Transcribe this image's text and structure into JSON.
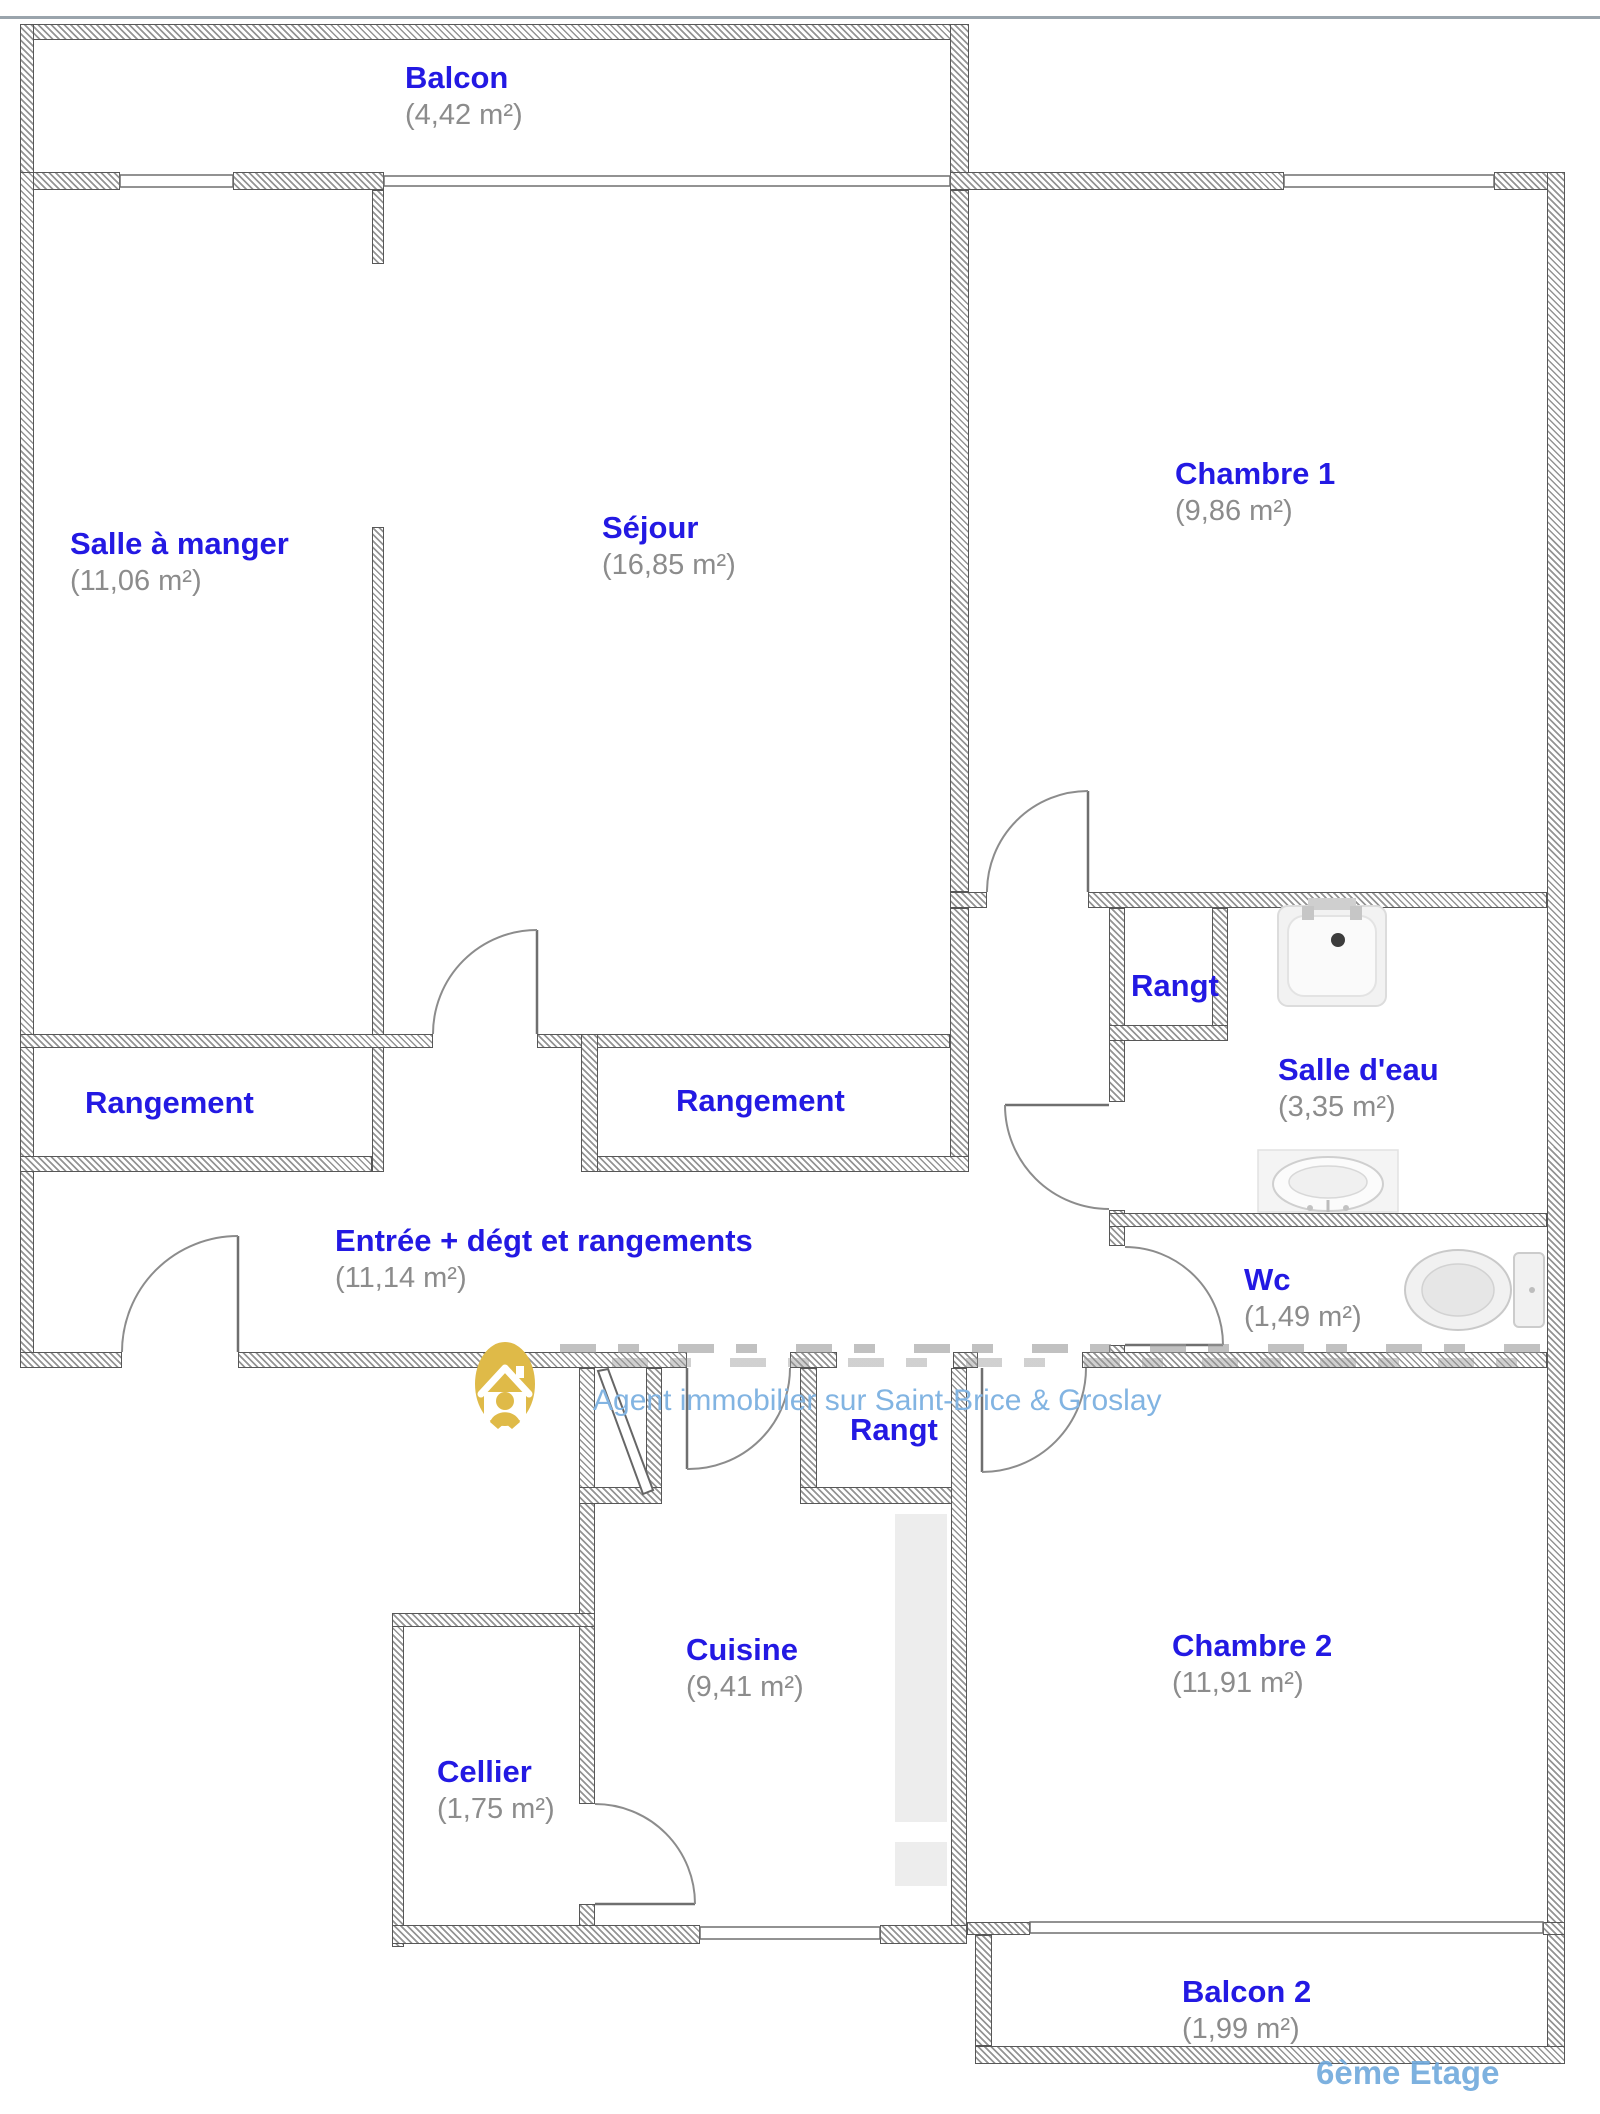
{
  "colors": {
    "label_blue": "#2319e3",
    "area_gray": "#8c8c8c",
    "wall_gray": "#949494",
    "watermark_blue": "#82b4e2",
    "floor_text_blue": "#6fa9dc",
    "logo_gold": "#dfba48",
    "fixture_gray": "#f1f1f1"
  },
  "watermark": {
    "agency": "Agent immobilier sur Saint-Brice & Groslay",
    "floor": "6ème Etage",
    "logo_icon": "house-person-icon"
  },
  "rooms": {
    "balcon": {
      "name": "Balcon",
      "area": "(4,42 m²)"
    },
    "salle_a_manger": {
      "name": "Salle à manger",
      "area": "(11,06 m²)"
    },
    "sejour": {
      "name": "Séjour",
      "area": "(16,85 m²)"
    },
    "chambre1": {
      "name": "Chambre 1",
      "area": "(9,86 m²)"
    },
    "rangement_gauche": {
      "name": "Rangement"
    },
    "rangement_droit": {
      "name": "Rangement"
    },
    "rangt_salle_eau": {
      "name": "Rangt"
    },
    "salle_eau": {
      "name": "Salle d'eau",
      "area": "(3,35 m²)"
    },
    "entree": {
      "name": "Entrée + dégt et rangements",
      "area": "(11,14 m²)"
    },
    "wc": {
      "name": "Wc",
      "area": "(1,49 m²)"
    },
    "rangt_entree": {
      "name": "Rangt"
    },
    "cuisine": {
      "name": "Cuisine",
      "area": "(9,41 m²)"
    },
    "chambre2": {
      "name": "Chambre 2",
      "area": "(11,91 m²)"
    },
    "cellier": {
      "name": "Cellier",
      "area": "(1,75 m²)"
    },
    "balcon2": {
      "name": "Balcon 2",
      "area": "(1,99 m²)"
    }
  },
  "fixtures": {
    "shower": "shower-tray-icon",
    "sink": "sink-icon",
    "toilet": "toilet-icon"
  }
}
